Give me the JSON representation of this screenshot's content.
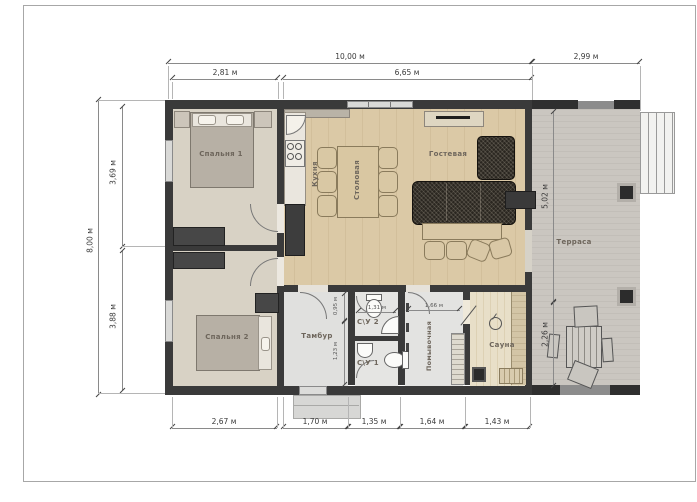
{
  "title": "План дома 10,00 × 8,00 м",
  "labels": {
    "bedroom1": "Спальня 1",
    "bedroom2": "Спальня 2",
    "kitchen": "Кухня",
    "dining": "Столовая",
    "living": "Гостевая",
    "terrace": "Терраса",
    "vestibule": "Тамбур",
    "wc2": "С\\У 2",
    "wc1": "С\\У 1",
    "washroom": "Помывочная",
    "sauna": "Сауна"
  },
  "dims": {
    "top_total": "10,00 м",
    "top_terrace": "2,99 м",
    "top_bedrooms": "2,81 м",
    "top_living": "6,65 м",
    "left_total": "8,00 м",
    "left_upper": "3,69 м",
    "left_lower": "3,88 м",
    "bottom": [
      "2,67 м",
      "1,70 м",
      "1,35 м",
      "1,64 м",
      "1,43 м"
    ],
    "terrace_upper": "5,02 м",
    "terrace_lower": "2,26 м",
    "vest_upper": "0,95 м",
    "vest_lower": "1,23 м",
    "wc2_width": "1,31 м",
    "washroom_width": "1,66 м"
  },
  "colors": {
    "wall": "#3a3a3a",
    "wood_floor": "#d8c6a2",
    "terrace_deck": "#c7c3bd",
    "bedroom_floor": "#d8d2c5",
    "sauna_floor": "#e4d9c0",
    "dim_line": "#8a8a8a",
    "room_label_text": "#6e665c"
  }
}
